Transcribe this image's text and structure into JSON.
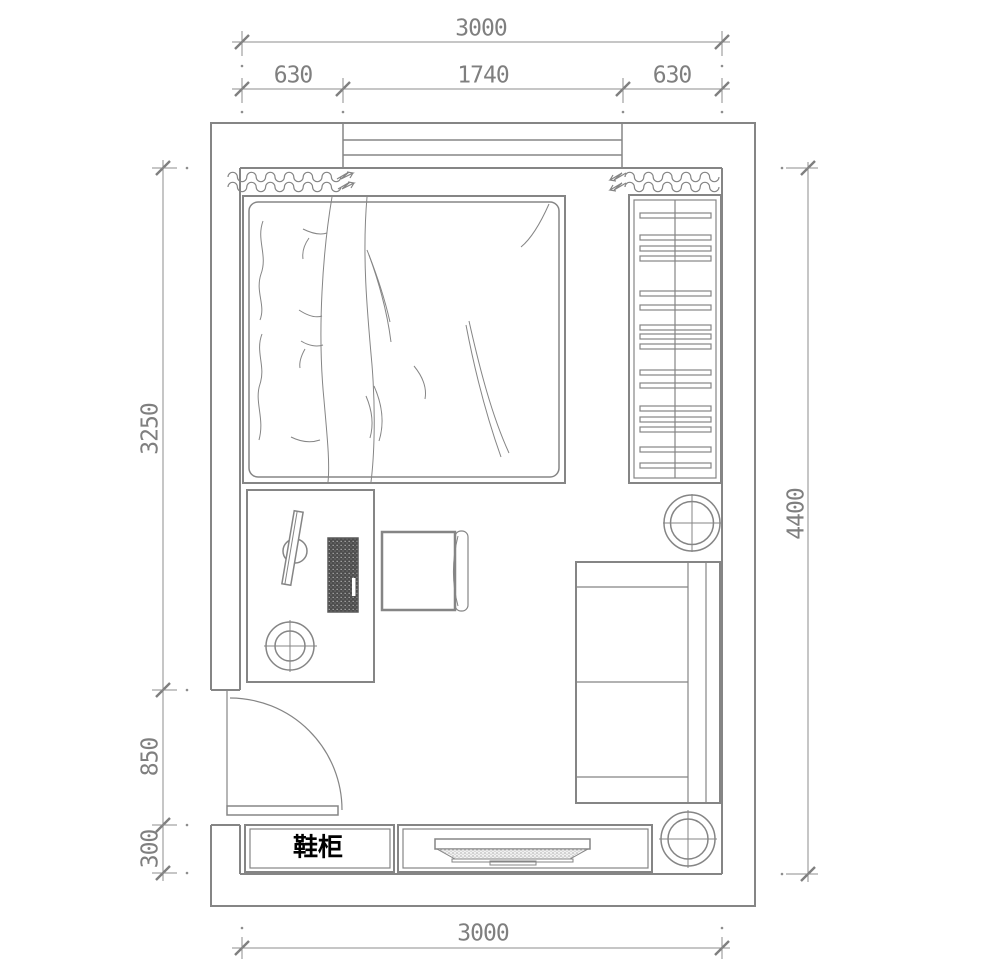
{
  "dimensions": {
    "top_total": "3000",
    "top_segments": [
      "630",
      "1740",
      "630"
    ],
    "left_segments": [
      "3250",
      "850",
      "300"
    ],
    "right_total": "4400",
    "bottom_total": "3000"
  },
  "labels": {
    "shoe_cabinet": "鞋柜"
  },
  "colors": {
    "line": "#858585",
    "dim_text": "#7f7f7f",
    "label_text": "#000000",
    "background": "#ffffff",
    "keyboard_fill": "#4d4d4d"
  },
  "furniture": [
    "window",
    "curtain-left",
    "curtain-right",
    "bed",
    "wardrobe",
    "desk",
    "monitor",
    "keyboard",
    "stool",
    "chair",
    "sofa",
    "round-table-top",
    "round-table-bottom",
    "door",
    "shoe-cabinet",
    "tv-cabinet",
    "tv"
  ]
}
